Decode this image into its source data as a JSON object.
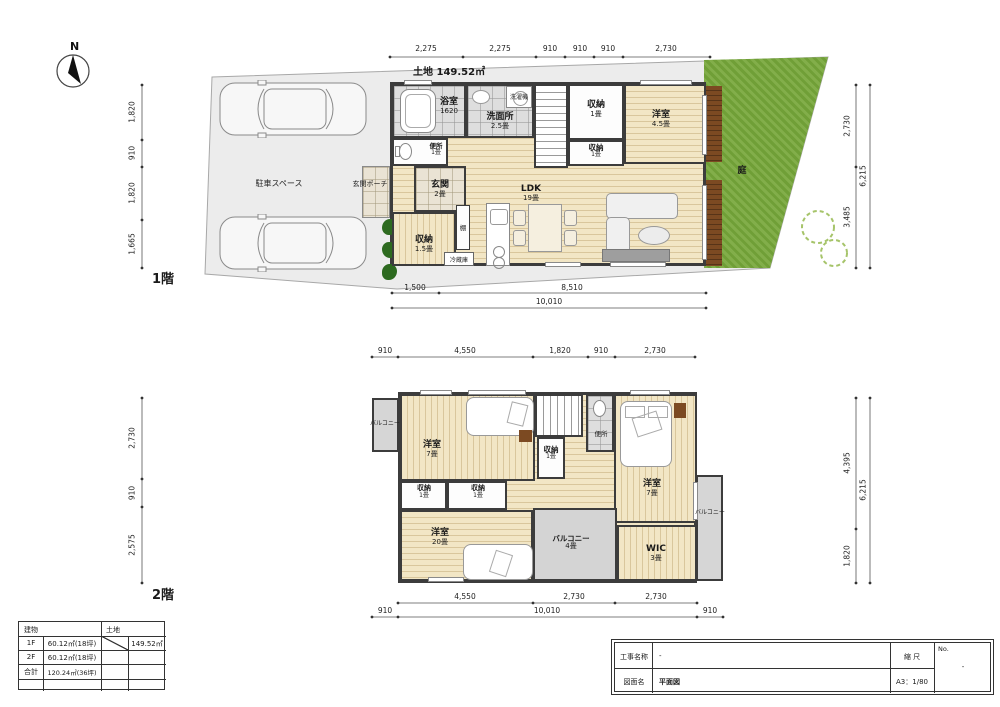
{
  "sheet": {
    "compass_label": "N"
  },
  "f1": {
    "floor_label": "1階",
    "land_label": "土地 149.52㎡",
    "dim_top": [
      "2,275",
      "2,275",
      "910",
      "910",
      "910",
      "2,730"
    ],
    "dim_left": [
      "1,820",
      "910",
      "1,820",
      "1,665"
    ],
    "dim_right": [
      "2,730",
      "3,485"
    ],
    "dim_right_total": "6,215",
    "dim_bottom": [
      "1,500",
      "8,510"
    ],
    "dim_bottom_total": "10,010",
    "rooms": {
      "bath": {
        "name": "浴室",
        "size": "1620"
      },
      "washroom": {
        "name": "洗面所",
        "size": "2.5畳"
      },
      "washer": "洗濯機",
      "closet_top": {
        "name": "収納",
        "size": "1畳"
      },
      "bedroom": {
        "name": "洋室",
        "size": "4.5畳"
      },
      "toilet": {
        "name": "便所",
        "size": "1畳"
      },
      "closet_mid": {
        "name": "収納",
        "size": "1畳"
      },
      "entrance": {
        "name": "玄関",
        "size": "2畳"
      },
      "porch": "玄関ポーチ",
      "ldk": {
        "name": "LDK",
        "size": "19畳"
      },
      "closet_low": {
        "name": "収納",
        "size": "1.5畳"
      },
      "shelf": "棚",
      "fridge": "冷蔵庫",
      "parking": "駐車スペース",
      "garden": "庭"
    }
  },
  "f2": {
    "floor_label": "2階",
    "dim_top": [
      "910",
      "4,550",
      "1,820",
      "910",
      "2,730"
    ],
    "dim_left": [
      "2,730",
      "910",
      "2,575"
    ],
    "dim_right": [
      "4,395",
      "1,820"
    ],
    "dim_right_total": "6,215",
    "dim_bottom1": [
      "4,550",
      "2,730",
      "2,730"
    ],
    "dim_bottom2": [
      "910",
      "10,010",
      "910"
    ],
    "rooms": {
      "balcony_left": "バルコニー",
      "bedroom_left": {
        "name": "洋室",
        "size": "7畳"
      },
      "closet_mid": {
        "name": "収納",
        "size": "1畳"
      },
      "toilet": "便所",
      "bedroom_right": {
        "name": "洋室",
        "size": "7畳"
      },
      "closet_a": {
        "name": "収納",
        "size": "1畳"
      },
      "closet_b": {
        "name": "収納",
        "size": "1畳"
      },
      "bedroom_main": {
        "name": "洋室",
        "size": "20畳"
      },
      "balcony_4": {
        "name": "バルコニー",
        "size": "4畳"
      },
      "wic": {
        "name": "WIC",
        "size": "3畳"
      },
      "balcony_right": "バルコニー"
    }
  },
  "area_table": {
    "building_header": "建物",
    "land_header": "土地",
    "rows": [
      {
        "k": "1F",
        "v": "60.12㎡(18坪)"
      },
      {
        "k": "2F",
        "v": "60.12㎡(18坪)"
      },
      {
        "k": "合計",
        "v": "120.24㎡(36坪)"
      }
    ],
    "land_value": "149.52㎡"
  },
  "title_block": {
    "project_label": "工事名称",
    "project_value": "-",
    "scale_label": "縮 尺",
    "scale_value": "A3：1/80",
    "no_label": "No.",
    "no_value": "-",
    "name_label": "図面名",
    "name_value": "平面図"
  }
}
